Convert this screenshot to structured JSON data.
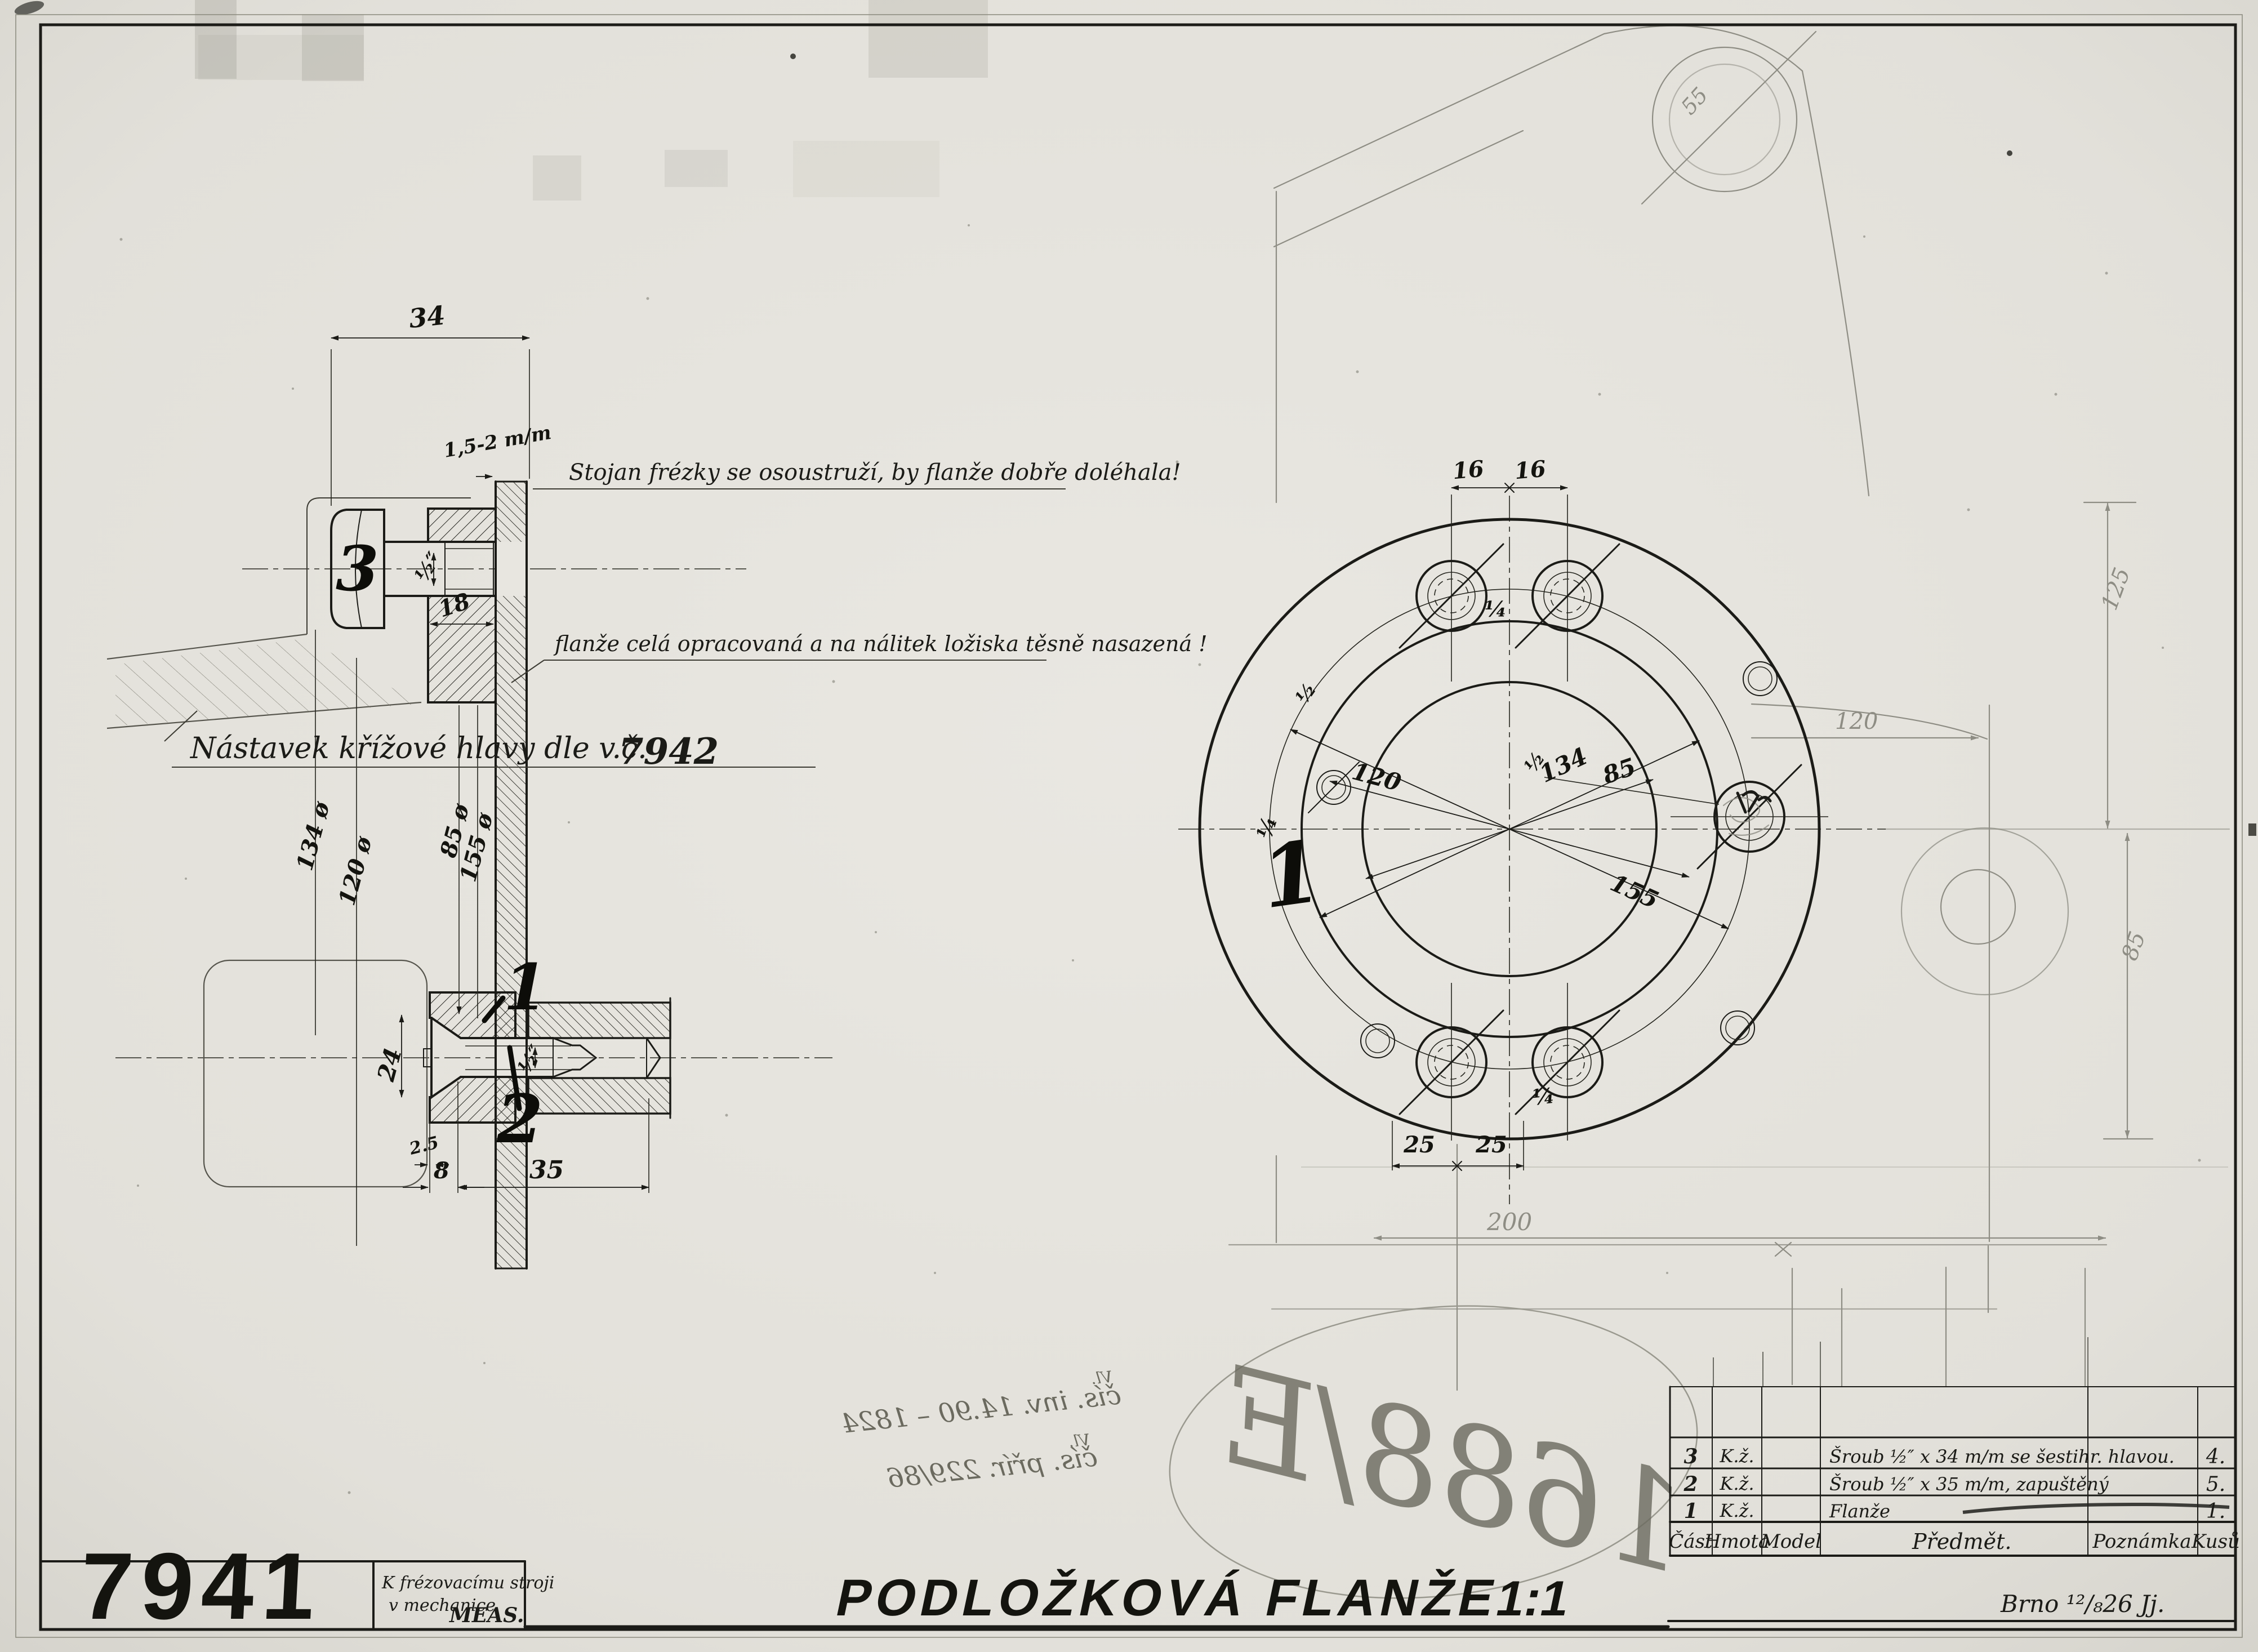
{
  "page": {
    "background": "#e8e6e0",
    "ink": "#1b1b17",
    "pencil": "#8e8d84"
  },
  "title_block": {
    "drawing_number": "7941",
    "machine_note": {
      "line1": "K frézovacímu stroji",
      "line2": "v mechanice",
      "org": "MEAS."
    },
    "title": "PODLOŽKOVÁ FLANŽE",
    "scale": "1:1",
    "place_date": "Brno ¹²/₈26 Jj."
  },
  "parts_table": {
    "headers": {
      "part": "Část",
      "material": "Hmota",
      "model": "Model",
      "subject": "Předmět.",
      "note": "Poznámka",
      "qty": "Kusů"
    },
    "rows": [
      {
        "part": "3",
        "material": "K.ž.",
        "model": "",
        "subject": "Šroub ½″ x 34 m/m se šestihr. hlavou.",
        "note": "",
        "qty": "4."
      },
      {
        "part": "2",
        "material": "K.ž.",
        "model": "",
        "subject": "Šroub ½″ x 35 m/m, zapuštěný",
        "note": "",
        "qty": "5."
      },
      {
        "part": "1",
        "material": "K.ž.",
        "model": "",
        "subject": "Flanže",
        "note": "",
        "qty": "1."
      }
    ]
  },
  "notes": {
    "stand": "Stojan frézky se osoustruží, by flanže dobře doléhala!",
    "flange": "flanže celá opracovaná a na nálitek ložiska těsně nasazená !",
    "crosshead": "Nástavek křížové hlavy dle v.č.",
    "crosshead_drawing": "7942"
  },
  "section_view": {
    "part_labels": [
      "3",
      "1",
      "2"
    ],
    "dims": {
      "width": "34",
      "allowance": "1,5-2 m/m",
      "bolt_thread": "½″",
      "flange_depth": "18",
      "dia_labels": [
        "134 ø",
        "120 ø",
        "85 ø",
        "155 ø"
      ],
      "hub": "24",
      "screw_thread": "½″",
      "step": "2.5",
      "head_len": "8",
      "screw_len": "35"
    }
  },
  "front_view": {
    "part_label": "1",
    "dims": {
      "offset_left": "16",
      "offset_right": "16",
      "quarter_top": "¼",
      "half_upper": "½",
      "quarter_left": "¼",
      "half_right": "½",
      "quarter_bottom": "¼",
      "bolt_circle": "120",
      "recess_dia": "134",
      "bore_dia": "85",
      "outer_circle": "155",
      "screw_left": "25",
      "screw_right": "25"
    }
  },
  "pencil_marks": {
    "boss_radius": "55",
    "overall": "200",
    "height_top": "125",
    "height_bottom": "85",
    "side": "120",
    "oval_code": "1688/E"
  },
  "stamps": {
    "inv_prefix": "Vl.",
    "inv": "čís. inv. 14.90 – 1824",
    "acq_prefix": "Vl.",
    "acq": "čís. přír. 229/86"
  }
}
